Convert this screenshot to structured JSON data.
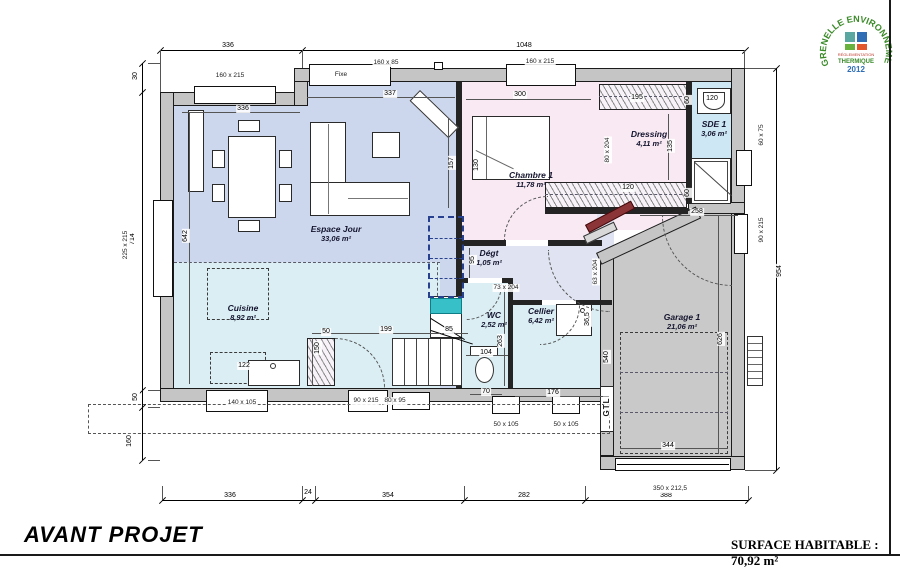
{
  "title_block": {
    "project_label": "AVANT PROJET",
    "surface_label": "SURFACE HABITABLE : 70,92 m²"
  },
  "logo": {
    "arc_text": "GRENELLE ENVIRONNEMENT",
    "line1": "RÉGLEMENTATION",
    "line2": "THERMIQUE",
    "line3": "2012",
    "arc_color": "#3a8a28",
    "line1_color": "#c0392b",
    "line2_color": "#3a8a28",
    "line3_color": "#2f6eb5",
    "squares": [
      "#5aa7a2",
      "#2f6eb5",
      "#6ab23e",
      "#e2572b"
    ]
  },
  "colors": {
    "wall": "#c5c5c5",
    "living": "#ccd7ee",
    "kitchen": "#daeef4",
    "bedroom": "#f8e9f3",
    "sde": "#cde7f4",
    "hall": "#e0e4f2",
    "garage": "#c9c9c9",
    "teal": "#37c0c8",
    "door_red": "#8c3538",
    "dash_blue": "#27418f"
  },
  "plan": {
    "rooms": [
      {
        "name": "Espace Jour",
        "area": "33,06 m²",
        "x": 336,
        "y": 234
      },
      {
        "name": "Cuisine",
        "area": "8,92 m²",
        "x": 243,
        "y": 313
      },
      {
        "name": "Chambre 1",
        "area": "11,78 m²",
        "x": 531,
        "y": 180
      },
      {
        "name": "Dressing",
        "area": "4,11 m²",
        "x": 649,
        "y": 139
      },
      {
        "name": "SDE 1",
        "area": "3,06 m²",
        "x": 714,
        "y": 129
      },
      {
        "name": "Dégt",
        "area": "1,05 m²",
        "x": 489,
        "y": 258
      },
      {
        "name": "WC",
        "area": "2,52 m²",
        "x": 494,
        "y": 320
      },
      {
        "name": "Cellier",
        "area": "6,42 m²",
        "x": 541,
        "y": 316
      },
      {
        "name": "Garage 1",
        "area": "21,06 m²",
        "x": 682,
        "y": 322
      }
    ],
    "dim_labels": [
      {
        "t": "336",
        "x": 228,
        "y": 46
      },
      {
        "t": "1048",
        "x": 524,
        "y": 46
      },
      {
        "t": "336",
        "x": 243,
        "y": 109
      },
      {
        "t": "337",
        "x": 390,
        "y": 94
      },
      {
        "t": "300",
        "x": 520,
        "y": 95
      },
      {
        "t": "195",
        "x": 637,
        "y": 98
      },
      {
        "t": "60",
        "x": 688,
        "y": 100,
        "r": -90
      },
      {
        "t": "120",
        "x": 712,
        "y": 99
      },
      {
        "t": "135",
        "x": 671,
        "y": 146,
        "r": -90
      },
      {
        "t": "120",
        "x": 628,
        "y": 188
      },
      {
        "t": "60",
        "x": 688,
        "y": 193,
        "r": -90
      },
      {
        "t": "258",
        "x": 697,
        "y": 212
      },
      {
        "t": "642",
        "x": 186,
        "y": 236,
        "r": -90
      },
      {
        "t": "157",
        "x": 452,
        "y": 163,
        "r": -90
      },
      {
        "t": "130",
        "x": 477,
        "y": 165,
        "r": -90
      },
      {
        "t": "95",
        "x": 473,
        "y": 260,
        "r": -90
      },
      {
        "t": "199",
        "x": 386,
        "y": 330
      },
      {
        "t": "85",
        "x": 449,
        "y": 330
      },
      {
        "t": "50",
        "x": 326,
        "y": 332
      },
      {
        "t": "150",
        "x": 318,
        "y": 348,
        "r": -90
      },
      {
        "t": "122",
        "x": 244,
        "y": 366
      },
      {
        "t": "104",
        "x": 486,
        "y": 353
      },
      {
        "t": "263",
        "x": 501,
        "y": 341,
        "r": -90
      },
      {
        "t": "70",
        "x": 486,
        "y": 392
      },
      {
        "t": "176",
        "x": 553,
        "y": 393
      },
      {
        "t": "36,5",
        "x": 588,
        "y": 319,
        "r": -90
      },
      {
        "t": "540",
        "x": 607,
        "y": 357,
        "r": -90
      },
      {
        "t": "626",
        "x": 721,
        "y": 339,
        "r": -90
      },
      {
        "t": "344",
        "x": 668,
        "y": 446
      },
      {
        "t": "954",
        "x": 780,
        "y": 271,
        "r": -90
      },
      {
        "t": "30",
        "x": 136,
        "y": 76,
        "r": -90
      },
      {
        "t": "714",
        "x": 133,
        "y": 239,
        "r": -90
      },
      {
        "t": "50",
        "x": 136,
        "y": 397,
        "r": -90
      },
      {
        "t": "160",
        "x": 130,
        "y": 441,
        "r": -90
      },
      {
        "t": "336",
        "x": 230,
        "y": 496
      },
      {
        "t": "24",
        "x": 308,
        "y": 493
      },
      {
        "t": "354",
        "x": 388,
        "y": 496
      },
      {
        "t": "282",
        "x": 524,
        "y": 496
      },
      {
        "t": "388",
        "x": 666,
        "y": 496
      }
    ],
    "size_labels": [
      {
        "t": "160 x 215",
        "x": 230,
        "y": 76
      },
      {
        "t": "160 x 85",
        "x": 386,
        "y": 63
      },
      {
        "t": "Fixe",
        "x": 341,
        "y": 75
      },
      {
        "t": "160 x 215",
        "x": 540,
        "y": 62
      },
      {
        "t": "225 x 215",
        "x": 126,
        "y": 245,
        "r": -90
      },
      {
        "t": "60 x 75",
        "x": 762,
        "y": 135,
        "r": -90
      },
      {
        "t": "90 x 215",
        "x": 762,
        "y": 230,
        "r": -90
      },
      {
        "t": "140 x 105",
        "x": 242,
        "y": 403
      },
      {
        "t": "90 x 215",
        "x": 366,
        "y": 401
      },
      {
        "t": "80 x 95",
        "x": 395,
        "y": 401
      },
      {
        "t": "50 x 105",
        "x": 506,
        "y": 425
      },
      {
        "t": "50 x 105",
        "x": 566,
        "y": 425
      },
      {
        "t": "350 x 212,5",
        "x": 670,
        "y": 489
      },
      {
        "t": "73 x 204",
        "x": 506,
        "y": 288
      },
      {
        "t": "63 x 204",
        "x": 596,
        "y": 272,
        "r": -90
      },
      {
        "t": "80 x 204",
        "x": 608,
        "y": 150,
        "r": -90
      },
      {
        "t": "GTL",
        "x": 607,
        "y": 407,
        "r": -90,
        "cls": "gtl"
      }
    ]
  }
}
